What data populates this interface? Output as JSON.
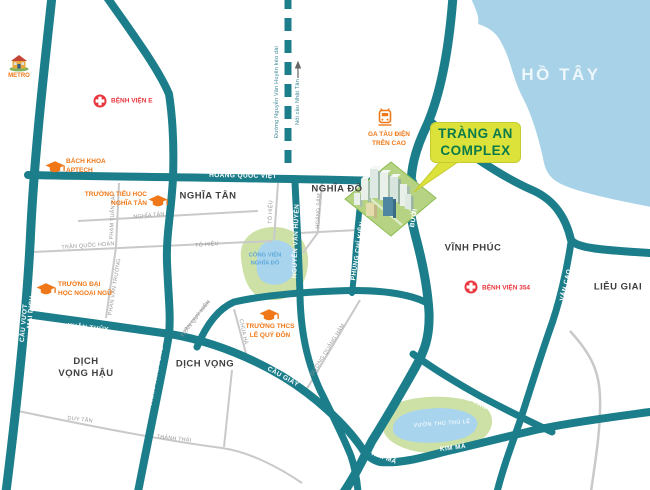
{
  "lake": {
    "label": "HỒ TÂY"
  },
  "areas": {
    "nghia_tan": "NGHĨA TÂN",
    "nghia_do": "NGHĨA ĐÔ",
    "vinh_phuc": "VĨNH PHÚC",
    "lieu_giai": "LIỄU GIAI",
    "dich_vong": "DỊCH VỌNG",
    "dich_vong_hau_1": "DỊCH",
    "dich_vong_hau_2": "VỌNG HẬU"
  },
  "parks": {
    "cong_vien_1": "CÔNG VIÊN",
    "cong_vien_2": "NGHĨA ĐÔ",
    "thu_le": "VƯỜN THÚ THỦ LỆ"
  },
  "roads": {
    "hoang_quoc_viet": "HOÀNG QUỐC VIỆT",
    "xuan_thuy": "XUÂN THỦY",
    "nguyen_van_huyen": "NGUYỄN VĂN HUYÊN",
    "phung_chi_kien": "PHÙNG CHÍ KIÊN",
    "buoi_upper": "BƯỞI",
    "buoi_lower": "BƯỞI",
    "tran_thai_tong": "TRẦN THÁI TÔNG",
    "cau_vuot": "CẦU VƯỢT",
    "mai_dich": "MAI DỊCH",
    "cau_giay": "CẦU GIẤY",
    "van_cao": "VĂN CAO",
    "dao_tan": "ĐÀO TẤN",
    "kim_ma_west": "KIM MÃ",
    "kim_ma": "KIM MÃ"
  },
  "minor_roads": {
    "pham_tuan_tai": "PHẠM TUẤN TÀI",
    "nghia_tan_street": "NGHĨA TÂN",
    "tran_quoc_hoan": "TRẦN QUỐC HOÀN",
    "to_hieu_h": "TÔ HIỆU",
    "to_hieu_v": "TÔ HIỆU",
    "hoang_sam": "HOÀNG SÂM",
    "phan_van_truong": "PHAN VĂN TRƯỜNG",
    "tran_quy_kien": "TRẦN QUÝ KIÊN",
    "chua_ha": "CHÙA HÀ",
    "duong_quang_ham": "DƯƠNG QUẢNG HÀM",
    "duy_tan": "DUY TÂN",
    "thanh_thai": "THÀNH THÁI"
  },
  "dashed_road": {
    "line1": "Đường Nguyễn Văn Huyên kéo dài",
    "line2": "Nối cầu Nhật Tân"
  },
  "pois": {
    "metro": "METRO",
    "benh_vien_e": "BỆNH VIỆN E",
    "bach_khoa_1": "BÁCH KHOA",
    "bach_khoa_2": "APTECH",
    "tieu_hoc_1": "TRƯỜNG TIỂU HỌC",
    "tieu_hoc_2": "NGHĨA TÂN",
    "dai_hoc_1": "TRƯỜNG ĐẠI",
    "dai_hoc_2": "HỌC NGOẠI NGỮ",
    "thcs_1": "TRƯỜNG THCS",
    "thcs_2": "LÊ QUÝ ĐÔN",
    "ga_tau_1": "GA TÀU ĐIỆN",
    "ga_tau_2": "TRÊN CAO",
    "benh_vien_354": "BỆNH VIỆN 354"
  },
  "callout": {
    "line1": "TRÀNG AN",
    "line2": "COMPLEX"
  },
  "colors": {
    "road_teal": "#1b7e8a",
    "minor_road_gray": "#c9c9c9",
    "lake_blue": "#a8d2e8",
    "park_green": "#cde1a6",
    "poi_orange": "#f07818",
    "hospital_red": "#e8363d",
    "callout_bg": "#dde23b",
    "callout_text": "#0a7a4a"
  }
}
